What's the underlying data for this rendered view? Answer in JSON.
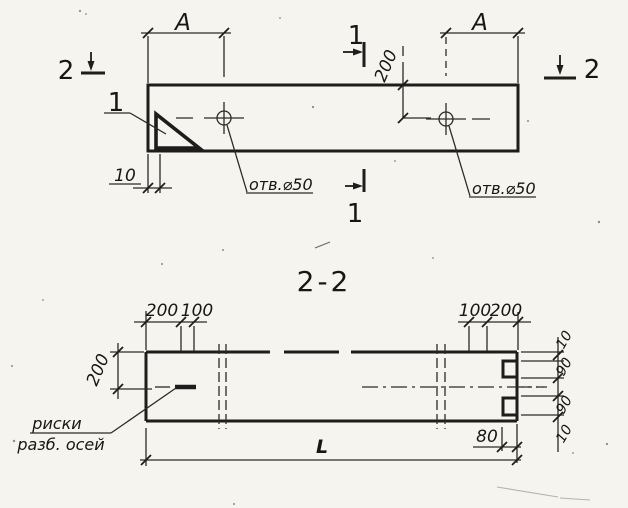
{
  "drawing": {
    "plan_view": {
      "span_label_left": "А",
      "span_label_right": "А",
      "hole_offset_label": "200",
      "edge_offset_label": "10",
      "hole_note_left": "отв.⌀50",
      "hole_note_right": "отв.⌀50",
      "detail_mark": "1",
      "section_1_top": "1",
      "section_1_bottom": "1",
      "section_2_left": "2",
      "section_2_right": "2"
    },
    "section_view": {
      "title": "2-2",
      "top_dims_left": [
        "200",
        "100"
      ],
      "top_dims_right": [
        "100",
        "200"
      ],
      "height_label": "200",
      "right_dims": [
        "10",
        "90",
        "90",
        "10"
      ],
      "notch_offset_label": "80",
      "length_label": "L",
      "axis_note": [
        "риски",
        "разб. осей"
      ]
    },
    "colors": {
      "ink": "#1e1d1b",
      "paper": "#f5f4ef"
    }
  }
}
